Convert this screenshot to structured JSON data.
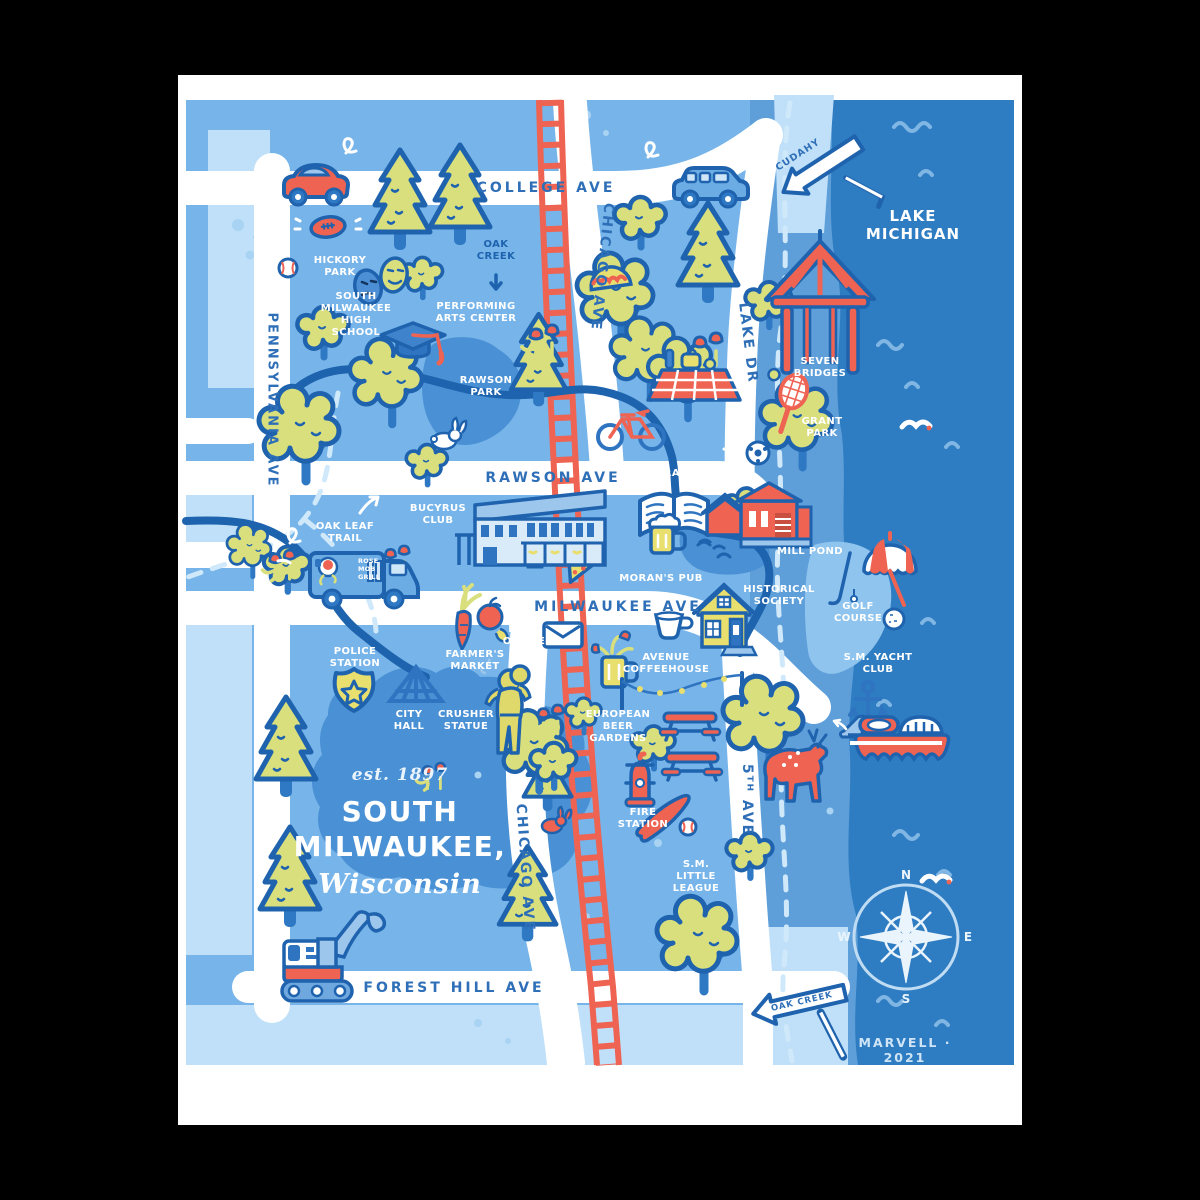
{
  "poster": {
    "title": {
      "est": "est. 1897",
      "city_line1": "SOUTH",
      "city_line2": "MILWAUKEE,",
      "state": "Wisconsin"
    },
    "credit": "MARVELL · 2021",
    "lake_label": "LAKE\nMICHIGAN",
    "compass": {
      "n": "N",
      "e": "E",
      "s": "S",
      "w": "W"
    },
    "streets": {
      "college": "COLLEGE AVE",
      "chicago_north": "CHICAGO AVE",
      "chicago_south": "CHICAGO AVE",
      "pennsylvania": "PENNSYLVANIA AVE",
      "rawson": "RAWSON AVE",
      "milwaukee": "MILWAUKEE AVE",
      "lake_dr": "LAKE DR",
      "fifth": "5ᵀᴴ AVE",
      "forest_hill": "FOREST HILL AVE"
    },
    "signs": {
      "cudahy": "CUDAHY",
      "oak_creek": "OAK CREEK"
    },
    "places": {
      "hickory_park": "HICKORY\nPARK",
      "oak_creek_label": "OAK\nCREEK",
      "high_school": "SOUTH\nMILWAUKEE\nHIGH\nSCHOOL",
      "arts_center": "PERFORMING\nARTS CENTER",
      "rawson_park": "RAWSON\nPARK",
      "seven_bridges": "SEVEN\nBRIDGES",
      "grant_park": "GRANT\nPARK",
      "library": "LIBRARY",
      "oak_leaf_trail": "OAK LEAF\nTRAIL",
      "bucyrus_club": "BUCYRUS\nCLUB",
      "mill_pond": "MILL POND",
      "morans_pub": "MORAN'S PUB",
      "historical_society": "HISTORICAL\nSOCIETY",
      "golf_course": "GOLF\nCOURSE",
      "yacht_club": "S.M. YACHT\nCLUB",
      "police_station": "POLICE\nSTATION",
      "farmers_market": "FARMER'S\nMARKET",
      "post_office": "POST\nOFFICE",
      "avenue_coffeehouse": "AVENUE\nCOFFEEHOUSE",
      "city_hall": "CITY\nHALL",
      "crusher_statue": "CRUSHER\nSTATUE",
      "beer_gardens": "EUROPEAN\nBEER\nGARDENS",
      "fire_station": "FIRE\nSTATION",
      "little_league": "S.M.\nLITTLE\nLEAGUE"
    },
    "truck": {
      "label": "ROSE\nMOB\nGRILL"
    },
    "colors": {
      "land": "#76B4E9",
      "pale_block": "#BFE0F8",
      "shore": "#5E9FD9",
      "lake": "#2E7CC1",
      "pond": "#4A90D4",
      "outline": "#1F63AE",
      "coral": "#EE6352",
      "tree_green": "#D9DF7C",
      "yellow": "#E8DF6F",
      "street_text": "#2E6FB8"
    }
  }
}
